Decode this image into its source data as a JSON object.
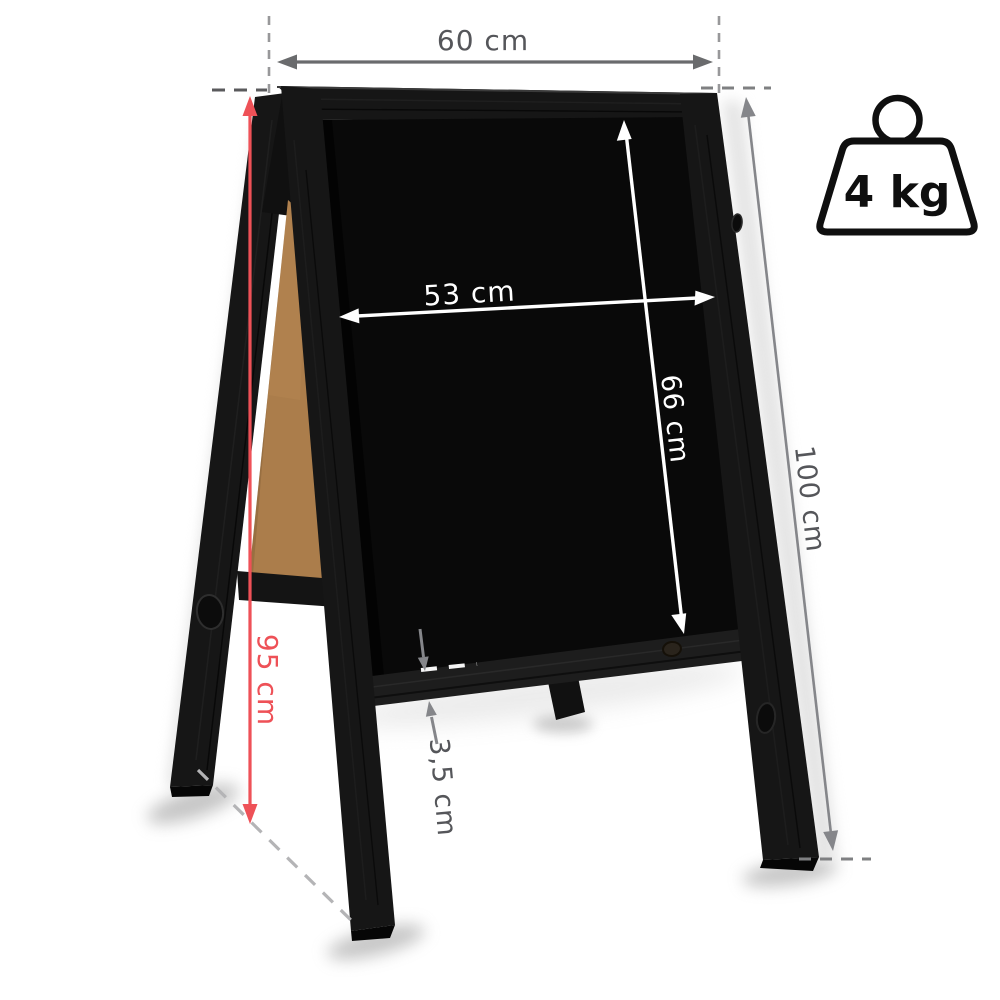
{
  "product": {
    "name": "a-frame-chalkboard-sandwich-board",
    "frame_finish": "black wood",
    "back_panel": "natural hardboard"
  },
  "annotations": {
    "outer_width": {
      "label": "60 cm"
    },
    "writing_width": {
      "label": "53 cm"
    },
    "writing_height": {
      "label": "66 cm"
    },
    "total_height": {
      "label": "100 cm"
    },
    "side_height": {
      "label": "95 cm"
    },
    "frame_lip": {
      "label": "3,5 cm"
    }
  },
  "weight_badge": {
    "icon": "weight-icon",
    "label": "4 kg"
  },
  "colors": {
    "accent_red": "#ee5157",
    "dim_text_gray": "#55565a",
    "arrow_gray": "#6a6b6d",
    "arrow_gray_light": "#85868a",
    "dash_gray": "#98989a",
    "dash_dark": "#5a5a5c",
    "dash_mid": "#7f8082",
    "dash_light": "#b4b4b6",
    "white": "#ffffff",
    "frame_black": "#161616",
    "rail_black": "#1d1d1d",
    "chalk_black": "#090909",
    "mdf_brown": "#ab7d4b",
    "icon_outline": "#0f0f0f"
  }
}
